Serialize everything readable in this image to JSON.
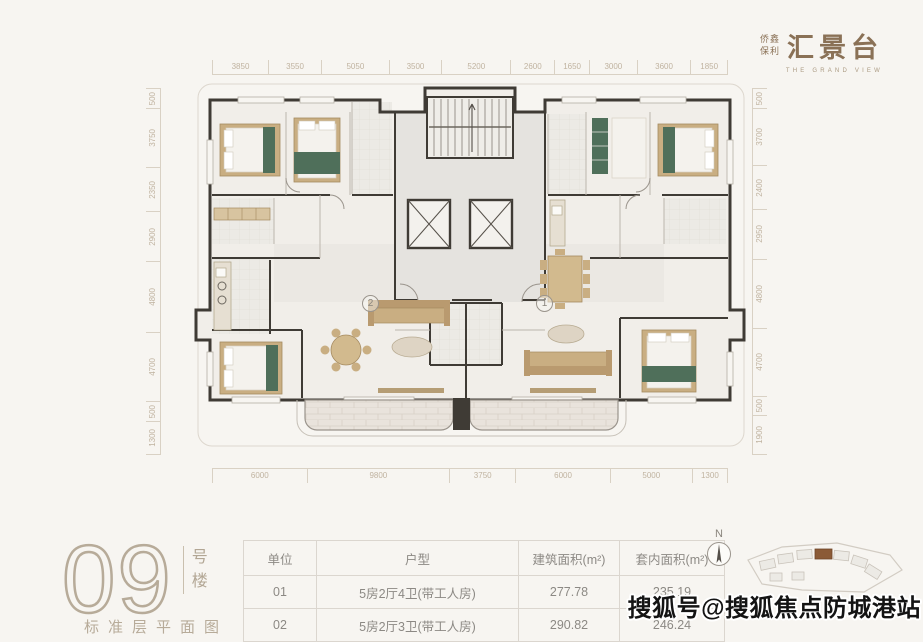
{
  "logo": {
    "brand_top": "侨鑫",
    "brand_bottom": "保利",
    "title": "汇景台",
    "tagline": "THE GRAND VIEW"
  },
  "plan": {
    "dims_top": [
      "3850",
      "3550",
      "5050",
      "3500",
      "5200",
      "2600",
      "1650",
      "3000",
      "3600",
      "1850"
    ],
    "dims_bottom": [
      "6000",
      "9800",
      "3750",
      "6000",
      "5000",
      "1300"
    ],
    "dims_left": [
      "500",
      "3750",
      "2350",
      "2900",
      "4800",
      "4700",
      "500",
      "1300"
    ],
    "dims_right": [
      "500",
      "3700",
      "2400",
      "2950",
      "4800",
      "4700",
      "500",
      "1900"
    ],
    "units": [
      {
        "label": "2"
      },
      {
        "label": "1"
      }
    ]
  },
  "building": {
    "number": "09",
    "suffix_top": "号",
    "suffix_bottom": "楼",
    "caption": "标准层平面图"
  },
  "table": {
    "headers": [
      "单位",
      "户型",
      "建筑面积(m²)",
      "套内面积(m²)"
    ],
    "col_widths": [
      60,
      189,
      88,
      92
    ],
    "rows": [
      [
        "01",
        "5房2厅4卫(带工人房)",
        "277.78",
        "235.19"
      ],
      [
        "02",
        "5房2厅3卫(带工人房)",
        "290.82",
        "246.24"
      ]
    ]
  },
  "compass": {
    "label": "N"
  },
  "watermark": {
    "text": "搜狐号@搜狐焦点防城港站"
  },
  "colors": {
    "background": "#f7f5f1",
    "wall": "#3f3b35",
    "dim_text": "#c0b3a0",
    "brand_brown": "#8a7156",
    "accent_green": "#4f6f5a",
    "furniture_tan": "#c9ae82",
    "highlight_brown": "#8b5a36",
    "watermark_black": "#141414"
  }
}
